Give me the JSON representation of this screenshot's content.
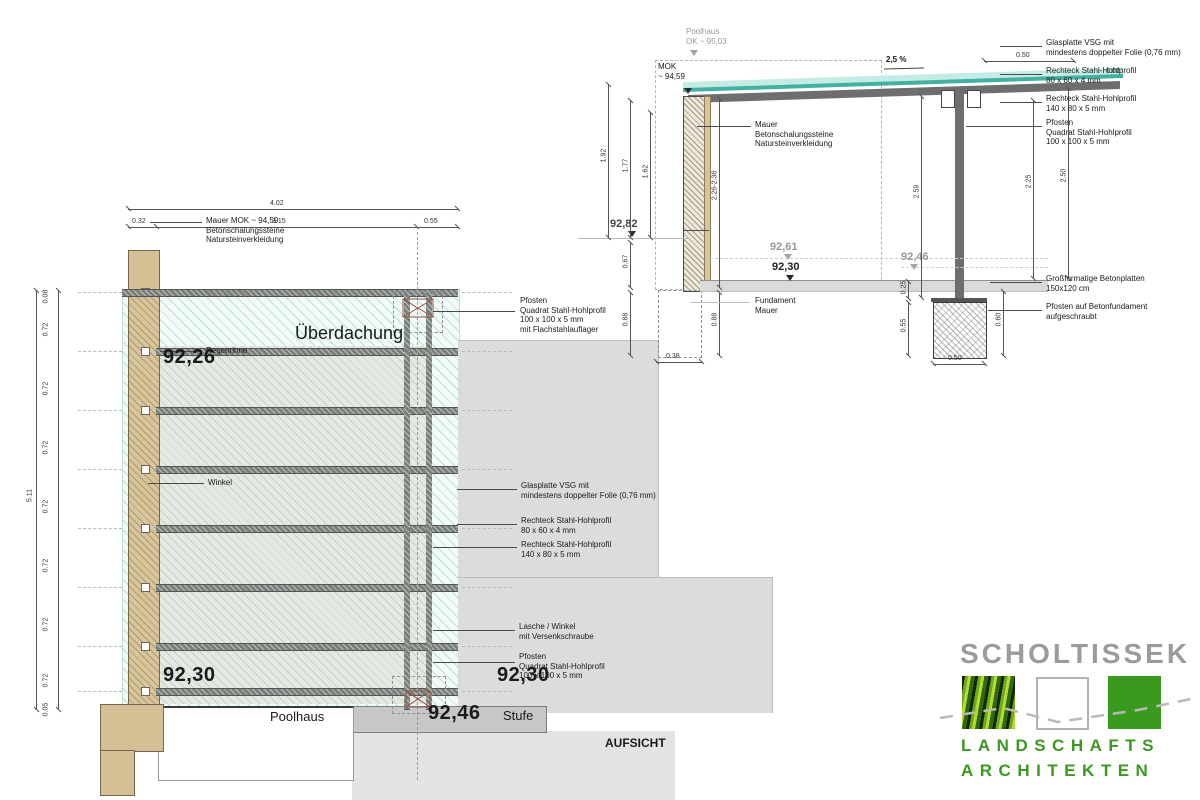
{
  "plan": {
    "title": "AUFSICHT",
    "canopy_label": "Überdachung",
    "poolhaus": "Poolhaus",
    "stufe": "Stufe",
    "level_9226": "92,26",
    "level_9230_left": "92,30",
    "level_9230_right": "92,30",
    "level_9246": "92,46",
    "dim_total_width": "4.02",
    "dim_w1": "0.32",
    "dim_w2": "3.15",
    "dim_w3": "0.55",
    "dim_total_height": "5.11",
    "v_segments": [
      "0.08",
      "0.72",
      "0.72",
      "0.72",
      "0.72",
      "0.72",
      "0.72",
      "0.72",
      "0.05"
    ],
    "callout_mauer": "Mauer MOK ~ 94,59\nBetonschalungssteine\nNatursteinverkleidung",
    "callout_regenrinne": "Regenrinne",
    "callout_winkel": "Winkel",
    "callout_pfosten_top": "Pfosten\nQuadrat Stahl-Hohlprofil\n100 x 100 x 5 mm\nmit Flachstahlauflager",
    "callout_glasplatte": "Glasplatte VSG mit\nmindestens doppelter Folie (0,76 mm)",
    "callout_rechteck_80": "Rechteck Stahl-Hohlprofil\n80 x 60 x 4 mm",
    "callout_rechteck_140": "Rechteck Stahl-Hohlprofil\n140 x 80 x 5 mm",
    "callout_lasche": "Lasche / Winkel\nmit Versenkschraube",
    "callout_pfosten_bottom": "Pfosten\nQuadrat Stahl-Hohlprofil\n100 x 100 x 5 mm"
  },
  "section": {
    "poolhaus_ok": "Poolhaus\nOK ~ 95,03",
    "mok": "MOK\n~ 94,59",
    "slope": "2,5 %",
    "dim_overhang": "0.50",
    "dim_roof_edge": "0.02",
    "level_9282": "92,82",
    "level_9261": "92,61",
    "level_9246": "92,46",
    "level_9230": "92,30",
    "dim_192": "1.92",
    "dim_177": "1.77",
    "dim_162": "1.62",
    "dim_067": "0.67",
    "dim_088_left": "0.88",
    "dim_wall_range": "2.26-2.36",
    "dim_088_wall": "0.88",
    "dim_038": "0.38",
    "dim_259": "2.59",
    "dim_225": "2.25",
    "dim_250": "2.50",
    "dim_025": "0.25",
    "dim_055": "0.55",
    "dim_060": "0.60",
    "dim_050_found": "0.50",
    "callout_glasplatte": "Glasplatte VSG mit\nmindestens doppelter Folie (0,76 mm)",
    "callout_rechteck_80": "Rechteck Stahl-Hohlprofil\n80 x 60 x 4 mm",
    "callout_rechteck_140": "Rechteck Stahl-Hohlprofil\n140 x 80 x 5 mm",
    "callout_pfosten": "Pfosten\nQuadrat Stahl-Hohlprofil\n100 x 100 x 5 mm",
    "callout_mauer": "Mauer\nBetonschalungssteine\nNatursteinverkleidung",
    "callout_fundament": "Fundament\nMauer",
    "callout_betonplatten": "Großformatige Betonplatten\n150x120 cm",
    "callout_pfosten_fundament": "Pfosten auf Betonfundament\naufgeschraubt"
  },
  "logo": {
    "name": "SCHOLTISSEK",
    "line1": "LANDSCHAFTS",
    "line2": "ARCHITEKTEN",
    "green": "#3a9a1e",
    "gray": "#9b9b9b"
  }
}
